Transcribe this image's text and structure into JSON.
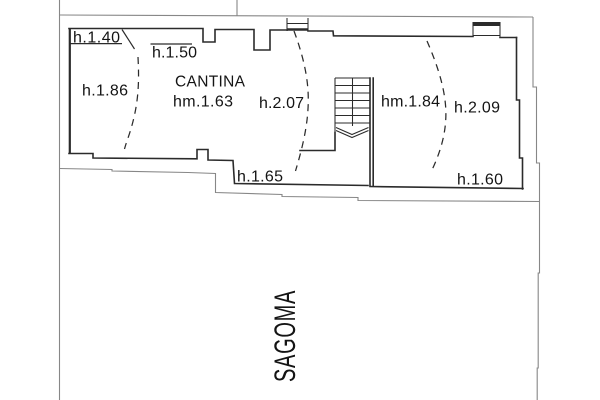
{
  "plan": {
    "room": {
      "name": "CANTINA",
      "mean_height": "hm.1.63"
    },
    "height_labels": {
      "top_left": "h.1.40",
      "top_center": "h.1.50",
      "left": "h.1.86",
      "center": "h.2.07",
      "right_of_stairs": "hm.1.84",
      "right": "h.2.09",
      "bottom_center": "h.1.65",
      "bottom_right": "h.1.60"
    },
    "outline_label": "SAGOMA",
    "colors": {
      "walls": "#2b2b2b",
      "ground_outline": "#878787",
      "text": "#141414",
      "background": "#ffffff"
    }
  }
}
